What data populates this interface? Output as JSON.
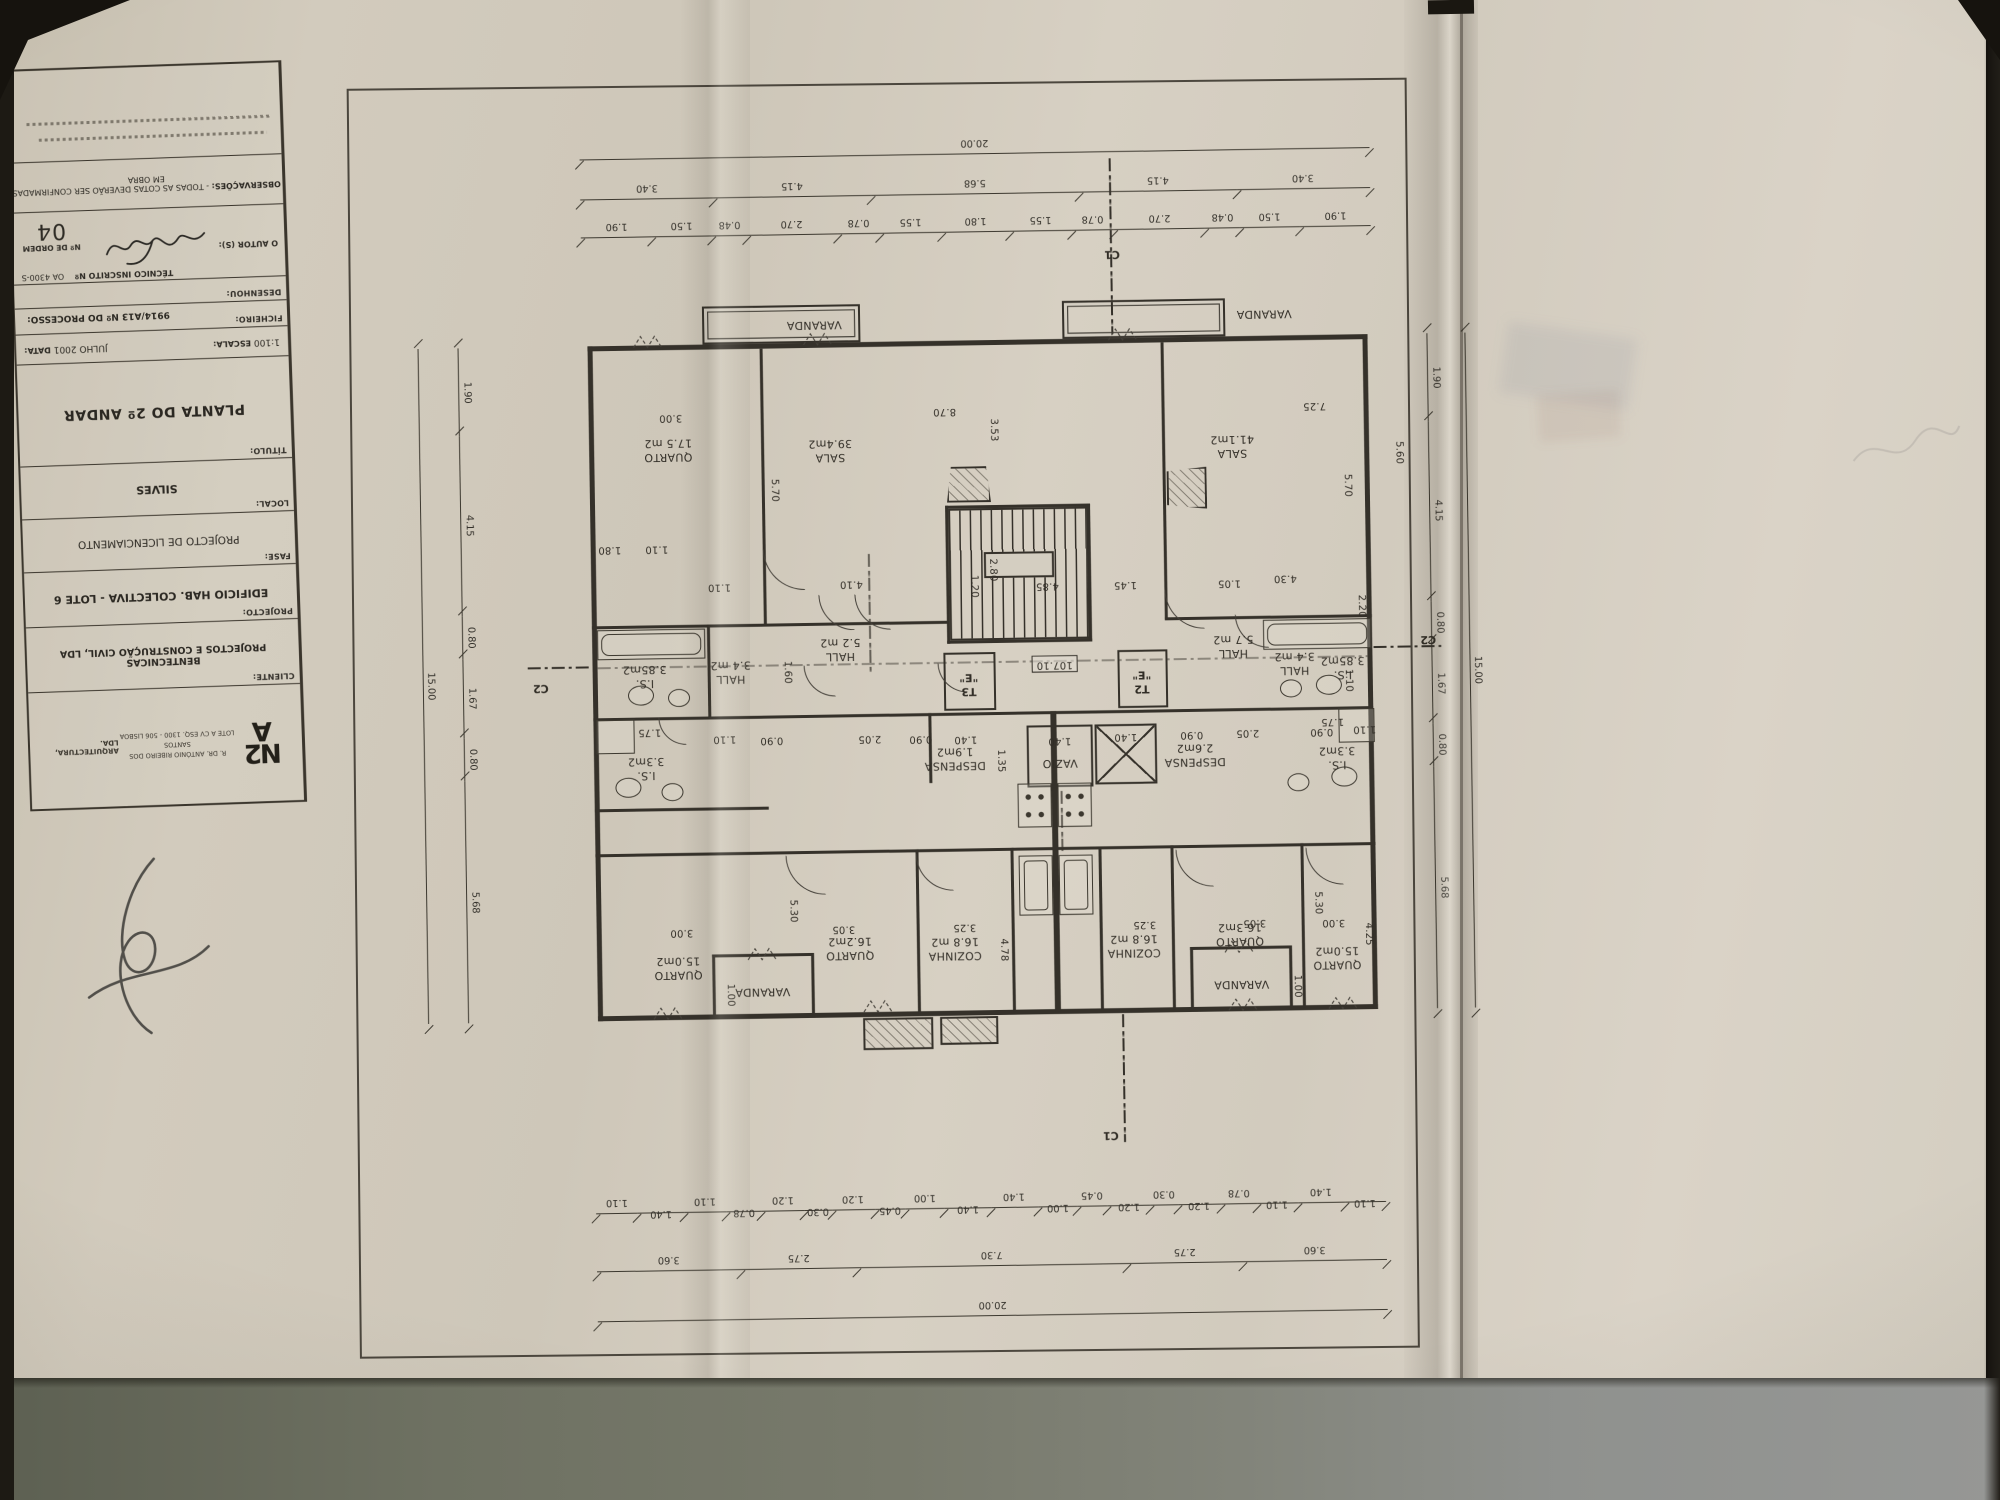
{
  "title_block": {
    "observations_label": "OBSERVAÇÕES:",
    "observations_text": "- TODAS AS COTAS DEVERÃO SER CONFIRMADAS EM OBRA",
    "tecnico_label": "TÉCNICO INSCRITO Nº",
    "tecnico_value": "OA 4300-S",
    "ordem_label": "Nº DE ORDEM",
    "ordem_value": "04",
    "autor_label": "O AUTOR (S):",
    "desenhou_label": "DESENHOU:",
    "ficheiro_label": "FICHEIRO:",
    "processo_label": "Nº DO PROCESSO:",
    "processo_value": "9914/A13",
    "escala_label": "ESCALA:",
    "escala_value": "1:100",
    "data_label": "DATA:",
    "data_value": "JULHO 2001",
    "titulo_label": "TÍTULO:",
    "titulo_value": "PLANTA DO 2º ANDAR",
    "local_label": "LOCAL:",
    "local_value": "SILVES",
    "fase_label": "FASE:",
    "fase_value": "PROJECTO DE LICENCIAMENTO",
    "projecto_label": "PROJECTO:",
    "projecto_value": "EDIFICIO  HAB. COLECTIVA - LOTE 6",
    "cliente_label": "CLIENTE:",
    "cliente_value": "BENTECNICAS\nPROJECTOS E CONSTRUÇÃO CIVIL, LDA",
    "logo_text": "N2\nA",
    "logo_sub": "ARQUITECTURA, LDA.",
    "logo_address": "R. DR. ANTÓNIO RIBEIRO DOS SANTOS\nLOTE A CV ESQ. 1300 - 506 LISBOA"
  },
  "plan": {
    "chains": {
      "top_total": [
        "20.00"
      ],
      "top_mid": [
        "3.40",
        "4.15",
        "5.68",
        "4.15",
        "3.40"
      ],
      "top_detail": [
        "1.90",
        "1.50",
        "0.48",
        "2.70",
        "0.78",
        "1.55",
        "1.80",
        "1.55",
        "0.78",
        "2.70",
        "0.48",
        "1.50",
        "1.90"
      ],
      "bottom_detail": [
        "1.10",
        "1.40",
        "1.10",
        "0.78",
        "1.20",
        "0.30",
        "1.20",
        "0.45",
        "1.00",
        "1.40",
        "1.40",
        "1.00",
        "0.45",
        "1.20",
        "0.30",
        "1.20",
        "0.78",
        "1.10",
        "1.40",
        "1.10"
      ],
      "bottom_mid": [
        "3.60",
        "2.75",
        "7.30",
        "2.75",
        "3.60"
      ],
      "bottom_total": [
        "20.00"
      ],
      "left_side": [
        "1.90",
        "4.15",
        "0.80",
        "1.67",
        "0.80",
        "5.68"
      ],
      "left_total": [
        "15.00"
      ],
      "right_side": [
        "1.90",
        "4.15",
        "0.80",
        "1.67",
        "0.80",
        "5.68"
      ],
      "right_total": [
        "15.00"
      ]
    },
    "labels": [
      {
        "id": "varanda_tl",
        "text": "VARANDA",
        "kind": "room"
      },
      {
        "id": "varanda_tr",
        "text": "VARANDA",
        "kind": "room"
      },
      {
        "id": "q17",
        "text": "QUARTO\n17.5 m2",
        "kind": "room"
      },
      {
        "id": "sala_l",
        "text": "SALA\n39.4m2",
        "kind": "room"
      },
      {
        "id": "sala_r",
        "text": "SALA\n41.1m2",
        "kind": "room"
      },
      {
        "id": "is385_l",
        "text": "I.S.\n3.85m2",
        "kind": "room"
      },
      {
        "id": "hall34_l",
        "text": "HALL\n3.4 m2",
        "kind": "room"
      },
      {
        "id": "hall52",
        "text": "HALL\n5.2 m2",
        "kind": "room"
      },
      {
        "id": "is33_l",
        "text": "I.S.\n3.3m2",
        "kind": "room"
      },
      {
        "id": "despensa_l",
        "text": "DESPENSA\n1.9m2",
        "kind": "room"
      },
      {
        "id": "vazio",
        "text": "VAZIO",
        "kind": "room"
      },
      {
        "id": "t3",
        "text": "T3\n\"E\"",
        "kind": "marker"
      },
      {
        "id": "t2",
        "text": "T2\n\"E\"",
        "kind": "marker"
      },
      {
        "id": "level",
        "text": "107.10",
        "kind": "level"
      },
      {
        "id": "hall57",
        "text": "HALL\n5.7 m2",
        "kind": "room"
      },
      {
        "id": "despensa_r",
        "text": "DESPENSA\n2.6m2",
        "kind": "room"
      },
      {
        "id": "hall34_r",
        "text": "HALL\n3.4 m2",
        "kind": "room"
      },
      {
        "id": "is385_r",
        "text": "I.S.\n3.85m2",
        "kind": "room"
      },
      {
        "id": "is33_r",
        "text": "I.S.\n3.3m2",
        "kind": "room"
      },
      {
        "id": "q15_l",
        "text": "QUARTO\n15.0m2",
        "kind": "room"
      },
      {
        "id": "q162",
        "text": "QUARTO\n16.2m2",
        "kind": "room"
      },
      {
        "id": "coz_l",
        "text": "COZINHA\n16.8 m2",
        "kind": "room"
      },
      {
        "id": "coz_r",
        "text": "COZINHA\n16.8 m2",
        "kind": "room"
      },
      {
        "id": "q163",
        "text": "QUARTO\n16.3m2",
        "kind": "room"
      },
      {
        "id": "q15_r",
        "text": "QUARTO\n15.0m2",
        "kind": "room"
      },
      {
        "id": "varanda_bl",
        "text": "VARANDA",
        "kind": "room"
      },
      {
        "id": "varanda_br",
        "text": "VARANDA",
        "kind": "room"
      },
      {
        "id": "c1_top",
        "text": "C1",
        "kind": "marker"
      },
      {
        "id": "c1_bot",
        "text": "C1",
        "kind": "marker"
      },
      {
        "id": "c2_l",
        "text": "C2",
        "kind": "marker"
      },
      {
        "id": "c2_r",
        "text": "C2",
        "kind": "marker"
      },
      {
        "id": "d300a",
        "text": "3.00",
        "kind": "dim"
      },
      {
        "id": "d570l",
        "text": "5.70",
        "kind": "dim"
      },
      {
        "id": "d870",
        "text": "8.70",
        "kind": "dim"
      },
      {
        "id": "d353",
        "text": "3.53",
        "kind": "dim"
      },
      {
        "id": "d725",
        "text": "7.25",
        "kind": "dim"
      },
      {
        "id": "d570r",
        "text": "5.70",
        "kind": "dim"
      },
      {
        "id": "d560",
        "text": "5.60",
        "kind": "dim"
      },
      {
        "id": "d180",
        "text": "1.80",
        "kind": "dim"
      },
      {
        "id": "d110a",
        "text": "1.10",
        "kind": "dim"
      },
      {
        "id": "d110b",
        "text": "1.10",
        "kind": "dim"
      },
      {
        "id": "d410",
        "text": "4.10",
        "kind": "dim"
      },
      {
        "id": "d120s",
        "text": "1.20",
        "kind": "dim"
      },
      {
        "id": "d280s",
        "text": "2.80",
        "kind": "dim"
      },
      {
        "id": "d485",
        "text": "4.85",
        "kind": "dim"
      },
      {
        "id": "d145",
        "text": "1.45",
        "kind": "dim"
      },
      {
        "id": "d105",
        "text": "1.05",
        "kind": "dim"
      },
      {
        "id": "d430",
        "text": "4.30",
        "kind": "dim"
      },
      {
        "id": "d160",
        "text": "1.60",
        "kind": "dim"
      },
      {
        "id": "d175l",
        "text": "1.75",
        "kind": "dim"
      },
      {
        "id": "d175r",
        "text": "1.75",
        "kind": "dim"
      },
      {
        "id": "d220",
        "text": "2.20",
        "kind": "dim"
      },
      {
        "id": "d110c",
        "text": "1.10",
        "kind": "dim"
      },
      {
        "id": "d110d",
        "text": "1.10",
        "kind": "dim"
      },
      {
        "id": "d090a",
        "text": "0.90",
        "kind": "dim"
      },
      {
        "id": "d205l",
        "text": "2.05",
        "kind": "dim"
      },
      {
        "id": "d090b",
        "text": "0.90",
        "kind": "dim"
      },
      {
        "id": "d140a",
        "text": "1.40",
        "kind": "dim"
      },
      {
        "id": "d140b",
        "text": "1.40",
        "kind": "dim"
      },
      {
        "id": "d140c",
        "text": "1.40",
        "kind": "dim"
      },
      {
        "id": "d090c",
        "text": "0.90",
        "kind": "dim"
      },
      {
        "id": "d205r",
        "text": "2.05",
        "kind": "dim"
      },
      {
        "id": "d090d",
        "text": "0.90",
        "kind": "dim"
      },
      {
        "id": "d110e",
        "text": "1.10",
        "kind": "dim"
      },
      {
        "id": "d135",
        "text": "1.35",
        "kind": "dim"
      },
      {
        "id": "d300b",
        "text": "3.00",
        "kind": "dim"
      },
      {
        "id": "d305l",
        "text": "3.05",
        "kind": "dim"
      },
      {
        "id": "d530l",
        "text": "5.30",
        "kind": "dim"
      },
      {
        "id": "d325l",
        "text": "3.25",
        "kind": "dim"
      },
      {
        "id": "d478",
        "text": "4.78",
        "kind": "dim"
      },
      {
        "id": "d325r",
        "text": "3.25",
        "kind": "dim"
      },
      {
        "id": "d305r",
        "text": "3.05",
        "kind": "dim"
      },
      {
        "id": "d300c",
        "text": "3.00",
        "kind": "dim"
      },
      {
        "id": "d530r",
        "text": "5.30",
        "kind": "dim"
      },
      {
        "id": "d425",
        "text": "4.25",
        "kind": "dim"
      },
      {
        "id": "d100l",
        "text": "1.00",
        "kind": "dim"
      },
      {
        "id": "d100r",
        "text": "1.00",
        "kind": "dim"
      }
    ]
  }
}
